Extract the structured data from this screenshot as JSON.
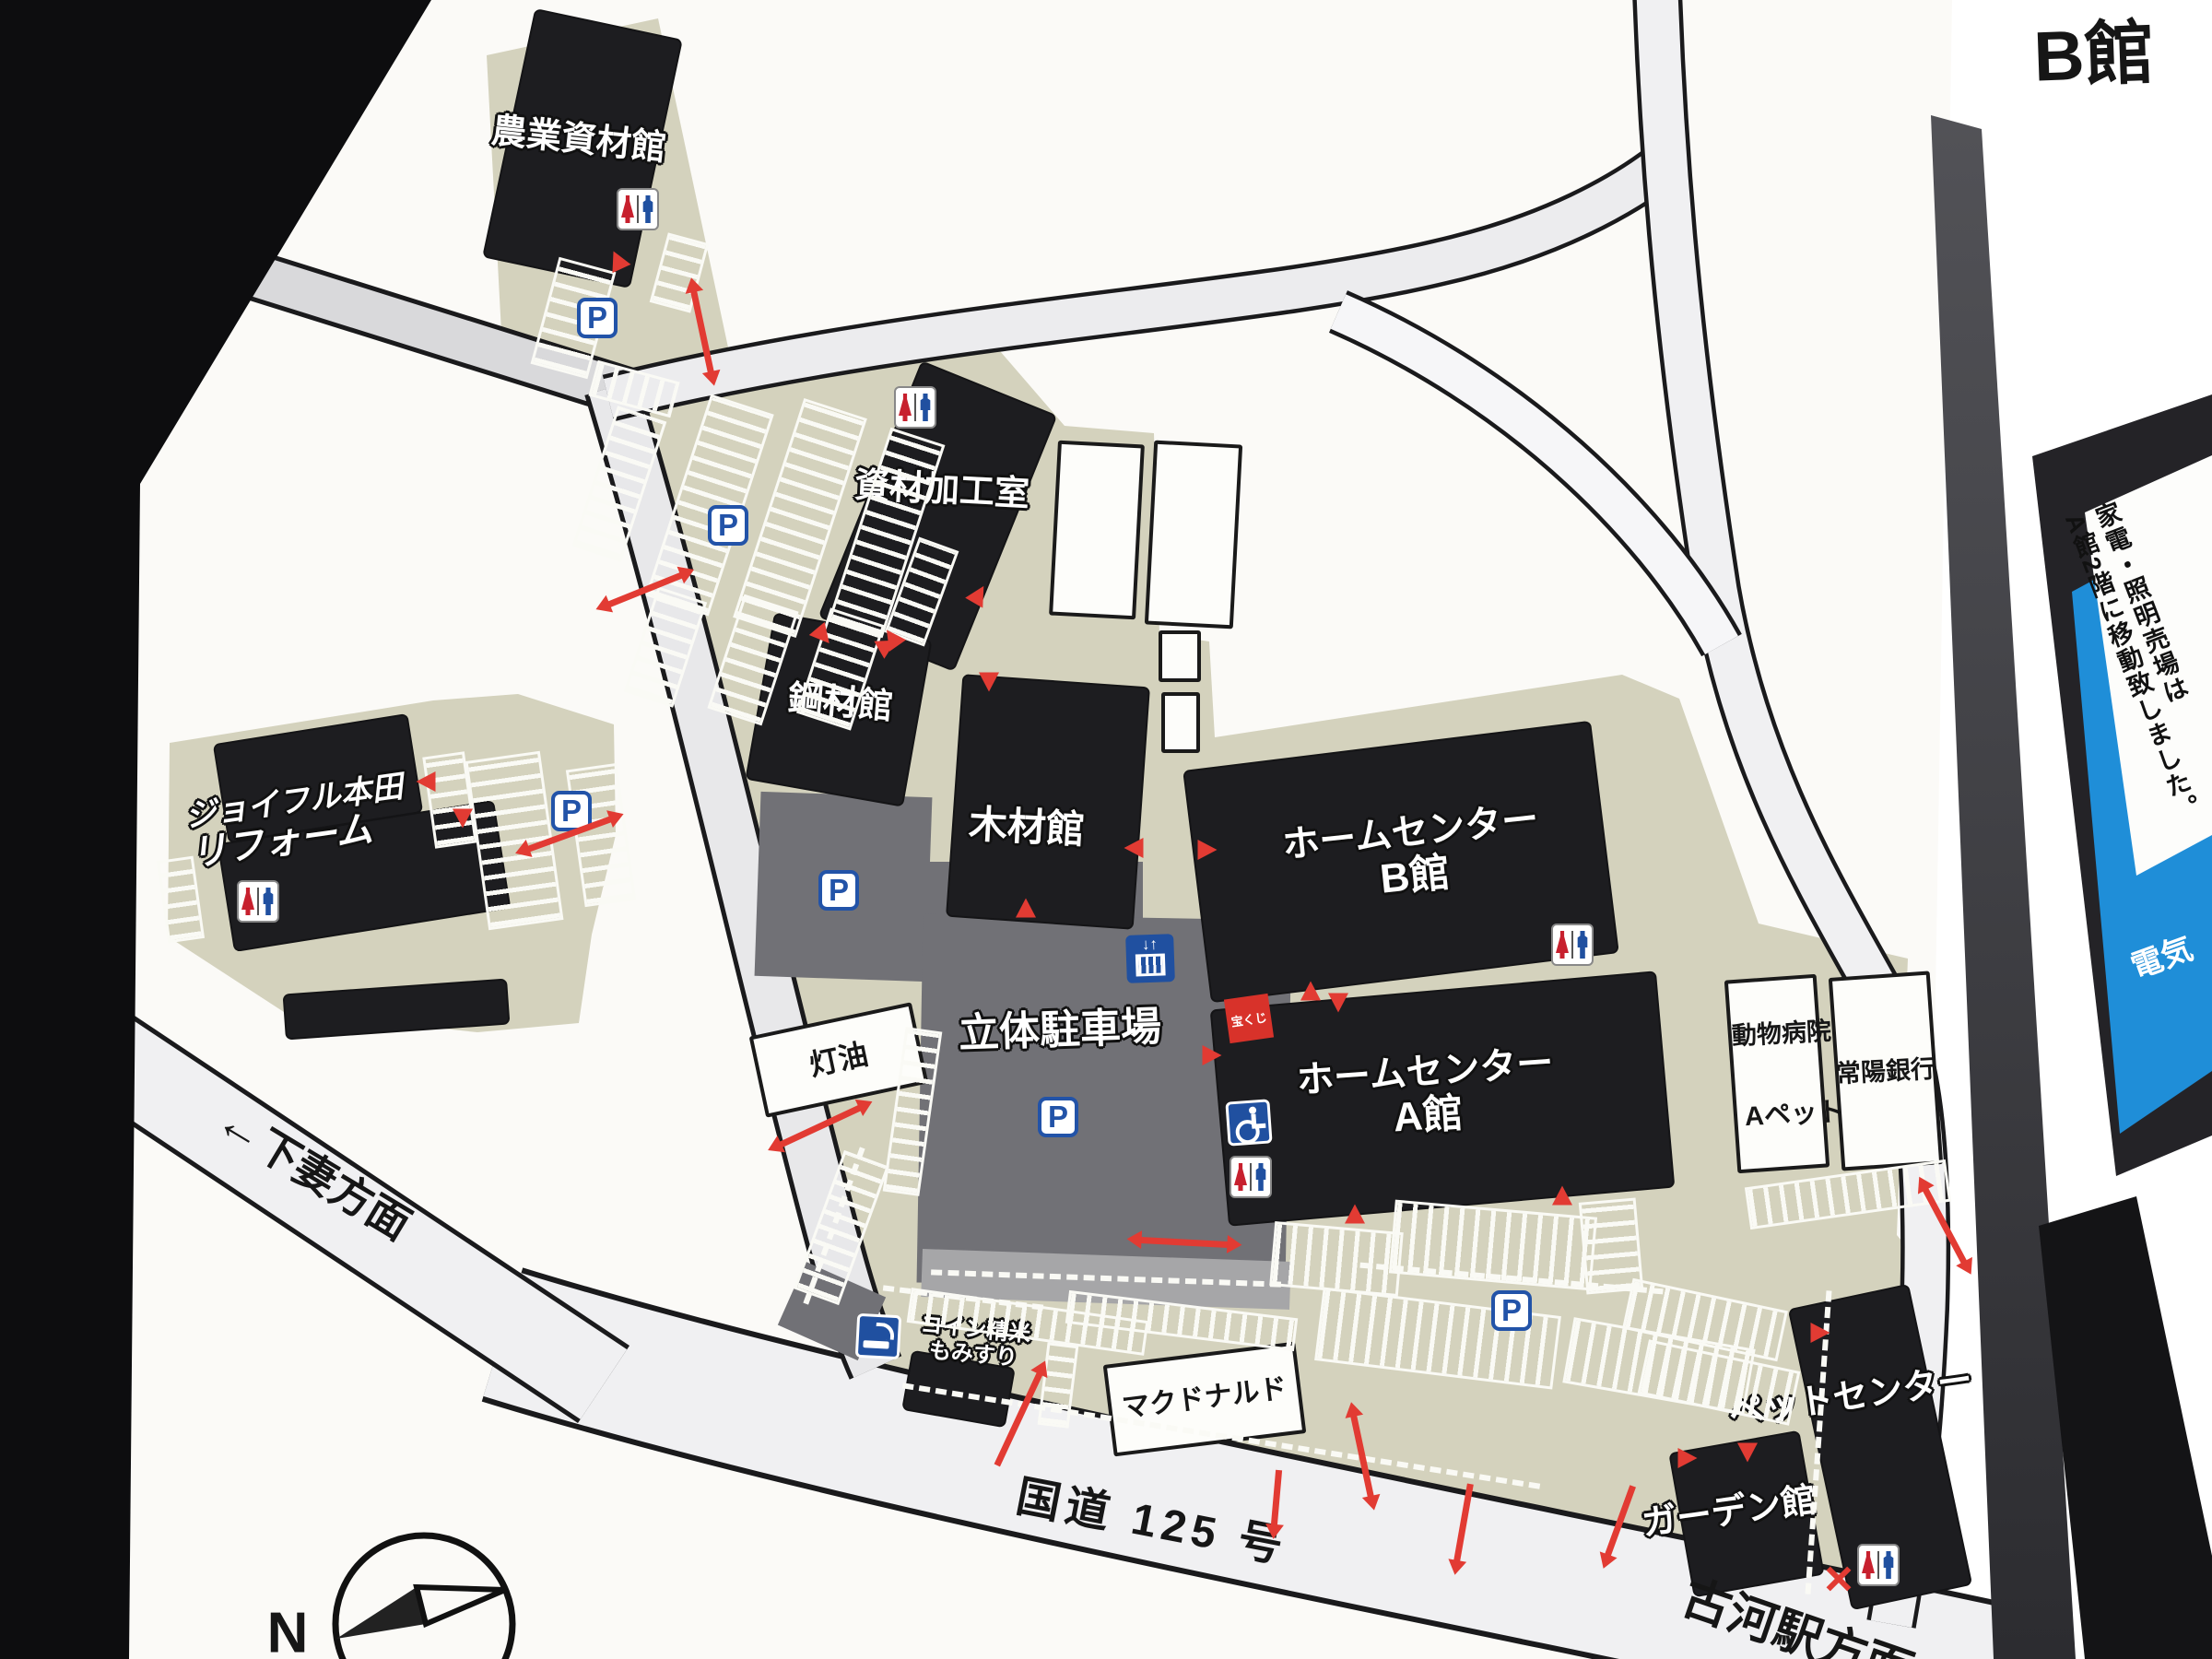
{
  "map": {
    "buildings": {
      "agri": "農業資材館",
      "processing": "資材加工室",
      "steel": "鋼材館",
      "wood": "木材館",
      "hc_b_line1": "ホームセンター",
      "hc_b_line2": "B館",
      "hc_a_line1": "ホームセンター",
      "hc_a_line2": "A館",
      "reform_line1": "ジョイフル本田",
      "reform_line2": "リフォーム",
      "parking_structure": "立体駐車場",
      "kerosene": "灯油",
      "coin_line1": "コイン精米",
      "coin_line2": "もみすり",
      "mcdonalds": "マクドナルド",
      "pet_center": "ペットセンター",
      "garden": "ガーデン館",
      "animal_hospital": "動物病院",
      "a_pet": "Aペット",
      "joyo_bank": "常陽銀行",
      "lottery": "宝くじ"
    },
    "roads": {
      "shimotsuma_arrow": "←",
      "shimotsuma": "下妻方面",
      "route125": "国道 125 号",
      "koga": "古河駅方面"
    },
    "compass": {
      "north": "N"
    },
    "icons": {
      "parking": "P",
      "elevator": "↓↑"
    },
    "colors": {
      "lot_beige": "#d4d2bd",
      "building_black": "#1d1d20",
      "parking_gray": "#717176",
      "marker_red": "#e23b33",
      "icon_blue": "#2050a0",
      "kiosk_blue": "#1f8ed8"
    }
  },
  "right_panel": {
    "b_kan": "B館",
    "notice_col1": "家電・照明売場は",
    "notice_col2": "A館2階に移動致しました。",
    "blue_text": "電気"
  }
}
